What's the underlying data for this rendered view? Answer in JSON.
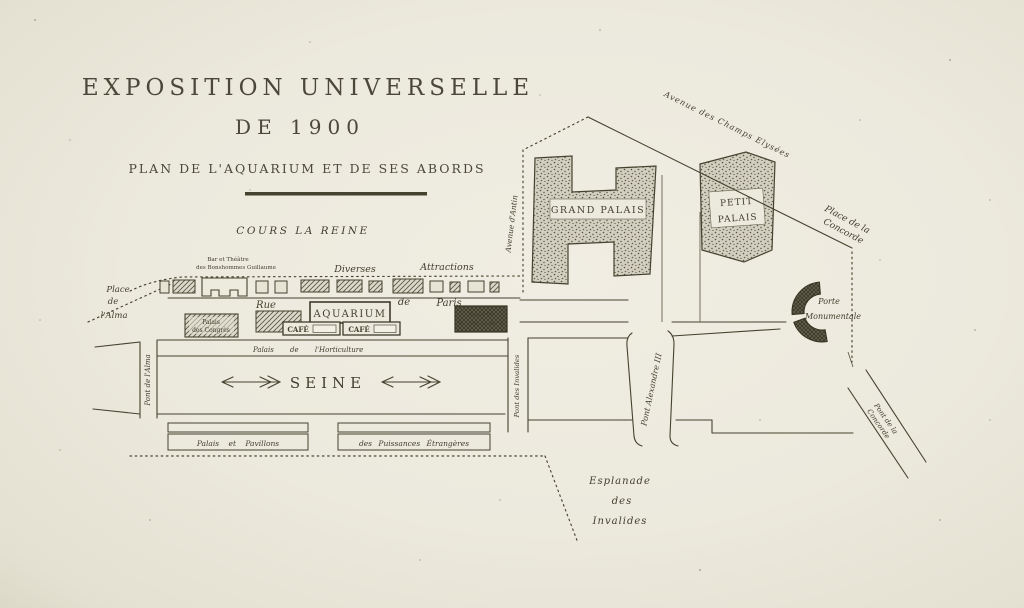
{
  "map": {
    "title_line1": "EXPOSITION UNIVERSELLE",
    "title_line2": "DE 1900",
    "subtitle": "PLAN DE L'AQUARIUM ET DE SES ABORDS",
    "river": "SEINE",
    "streets": {
      "cours_la_reine": "COURS LA REINE",
      "rue": "Rue",
      "de": "de",
      "paris": "Paris",
      "avenue_champs_elysees": "Avenue des Champs Elysées",
      "avenue_antin": "Avenue d'Antin"
    },
    "places": {
      "place_alma_l1": "Place",
      "place_alma_l2": "de",
      "place_alma_l3": "l'Alma",
      "place_concorde_l1": "Place de la",
      "place_concorde_l2": "Concorde",
      "esplanade_l1": "Esplanade",
      "esplanade_l2": "des",
      "esplanade_l3": "Invalides"
    },
    "bridges": {
      "pont_alma": "Pont de l'Alma",
      "pont_invalides": "Pont des Invalides",
      "pont_alexandre": "Pont Alexandre III",
      "pont_concorde_l1": "Pont de la",
      "pont_concorde_l2": "Concorde"
    },
    "buildings": {
      "grand_palais": "GRAND PALAIS",
      "petit_palais_l1": "PETIT",
      "petit_palais_l2": "PALAIS",
      "aquarium": "AQUARIUM",
      "cafe_left": "CAFÉ",
      "cafe_right": "CAFÉ",
      "palais_congres_l1": "Palais",
      "palais_congres_l2": "des Congrès",
      "palais_ville_l1": "Palais de",
      "palais_ville_l2": "la Ville de Paris",
      "horticulture": "Palais de l'Horticulture",
      "porte_monumentale_l1": "Porte",
      "porte_monumentale_l2": "Monumentale",
      "palais_pavillons": "Palais et Pavillons",
      "puissances_etrangeres": "des Puissances Étrangères",
      "bar_theatre_l1": "Bar et Théâtre",
      "bar_theatre_l2": "des Bonshommes Guillaume"
    },
    "attractions": {
      "diverses": "Diverses",
      "attractions": "Attractions"
    },
    "colors": {
      "paper": "#ece9dd",
      "ink": "#45422f"
    }
  }
}
